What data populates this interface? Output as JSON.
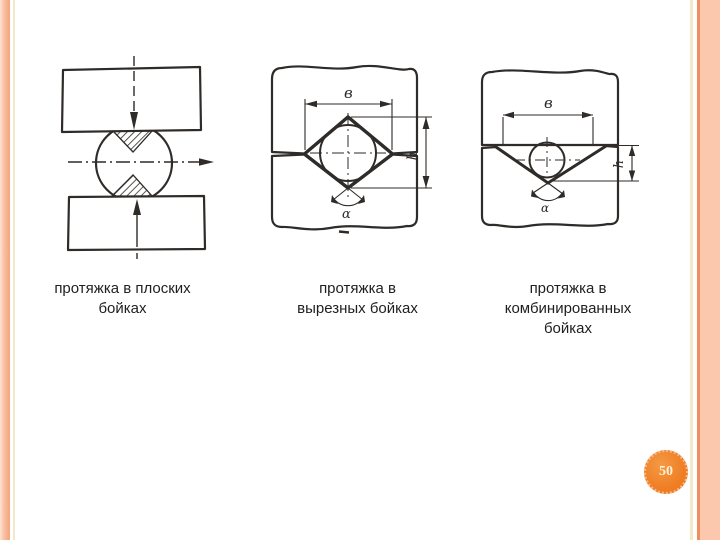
{
  "theme": {
    "accent_bar_color": "#f8c1a3",
    "accent_line_cream": "#f2e9cb",
    "accent_line_orange": "#ee8e5e",
    "badge_color": "#ef7e24"
  },
  "page": {
    "number": "50"
  },
  "figures": [
    {
      "caption_lines": [
        "протяжка в плоских",
        "бойках"
      ]
    },
    {
      "caption_lines": [
        "протяжка в",
        "вырезных бойках"
      ],
      "dims": {
        "width": "в",
        "height": "h",
        "angle": "α"
      }
    },
    {
      "caption_lines": [
        "протяжка в",
        "комбинированных",
        "бойках"
      ],
      "dims": {
        "width": "в",
        "height": "h",
        "angle": "α"
      }
    }
  ]
}
